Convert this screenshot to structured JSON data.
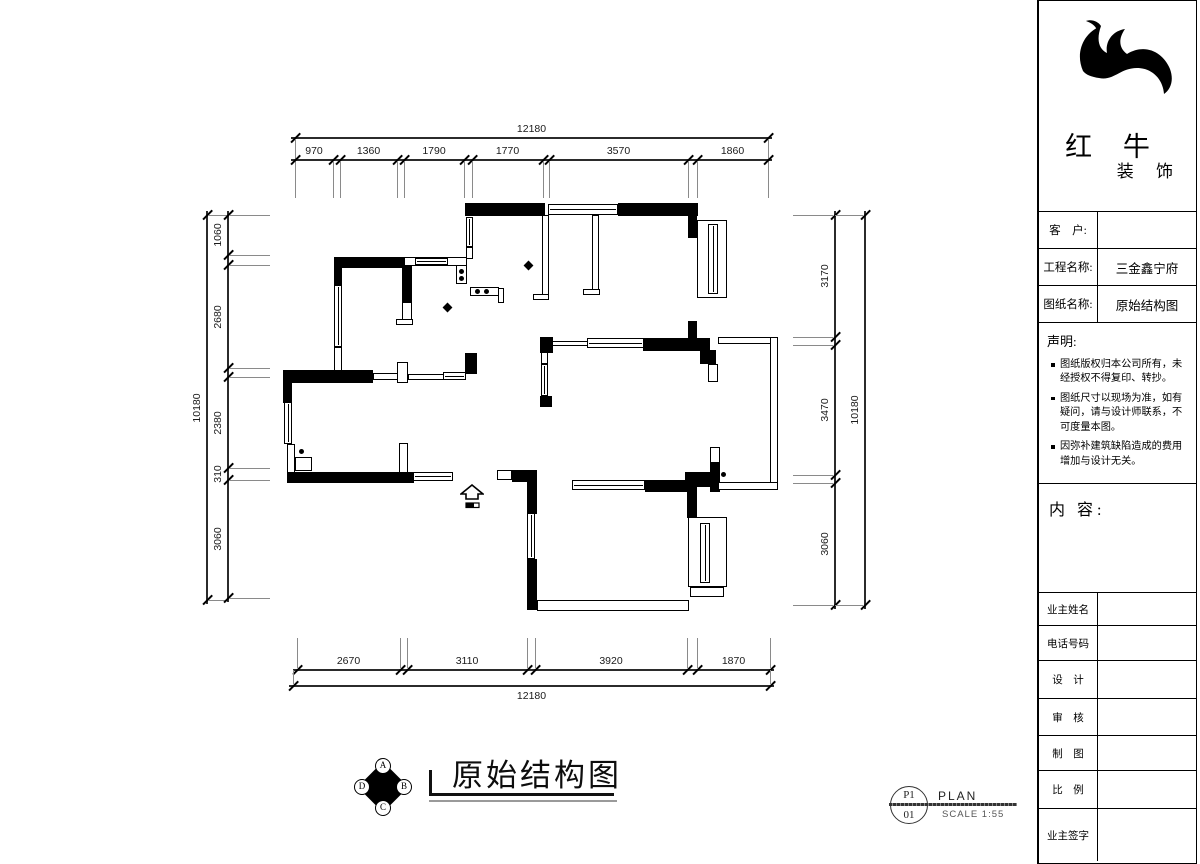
{
  "title_block": {
    "logo": {
      "line1": "红 牛",
      "line2": "装 饰"
    },
    "rows": [
      {
        "label": "客　户:",
        "value": ""
      },
      {
        "label": "工程名称:",
        "value": "三金鑫宁府"
      },
      {
        "label": "图纸名称:",
        "value": "原始结构图"
      }
    ],
    "statement": {
      "title": "声明:",
      "items": [
        "图纸版权归本公司所有，未经授权不得复印、转抄。",
        "图纸尺寸以现场为准，如有疑问，请与设计师联系，不可度量本图。",
        "因弥补建筑缺陷造成的费用增加与设计无关。"
      ]
    },
    "content_label": "内 容:",
    "sign_rows": [
      "业主姓名",
      "电话号码",
      "设　计",
      "审　核",
      "制　图",
      "比　例",
      "业主签字"
    ]
  },
  "plan_title": {
    "text": "原始结构图"
  },
  "compass": {
    "top": "A",
    "right": "B",
    "bottom": "C",
    "left": "D"
  },
  "stamp": {
    "sheet": "P1",
    "number": "01",
    "label": "PLAN",
    "scale": "SCALE 1:55"
  },
  "dimensions": {
    "top_total": "12180",
    "top_segments": [
      "970",
      "1360",
      "1790",
      "1770",
      "3570",
      "1860"
    ],
    "bottom_segments": [
      "2670",
      "3110",
      "3920",
      "1870"
    ],
    "bottom_total": "12180",
    "left_total": "10180",
    "left_segments": [
      "1060",
      "2680",
      "2380",
      "310",
      "3060"
    ],
    "right_segments": [
      "3170",
      "3470",
      "3060"
    ],
    "right_total": "10180"
  },
  "dim_rows": [
    {
      "o": "h",
      "y": 138,
      "x1": 295,
      "x2": 768,
      "ticks": [
        295,
        768
      ],
      "ext": {
        "dir": 1,
        "len": 22
      },
      "labels": [
        {
          "t": "12180",
          "a": 295,
          "b": 768
        }
      ]
    },
    {
      "o": "h",
      "y": 160,
      "x1": 295,
      "x2": 768,
      "ticks": [
        295,
        333,
        340,
        397,
        404,
        464,
        472,
        543,
        549,
        688,
        697,
        768
      ],
      "ext": {
        "dir": 1,
        "len": 36
      },
      "labels": [
        {
          "t": "970",
          "a": 295,
          "b": 333
        },
        {
          "t": "1360",
          "a": 340,
          "b": 397
        },
        {
          "t": "1790",
          "a": 404,
          "b": 464
        },
        {
          "t": "1770",
          "a": 472,
          "b": 543
        },
        {
          "t": "3570",
          "a": 549,
          "b": 688
        },
        {
          "t": "1860",
          "a": 697,
          "b": 768
        }
      ]
    },
    {
      "o": "h",
      "y": 670,
      "x1": 297,
      "x2": 770,
      "ticks": [
        297,
        400,
        407,
        527,
        535,
        687,
        697,
        770
      ],
      "ext": {
        "dir": -1,
        "len": 30
      },
      "labels": [
        {
          "t": "2670",
          "a": 297,
          "b": 400
        },
        {
          "t": "3110",
          "a": 407,
          "b": 527
        },
        {
          "t": "3920",
          "a": 535,
          "b": 687
        },
        {
          "t": "1870",
          "a": 697,
          "b": 770
        }
      ]
    },
    {
      "o": "h",
      "y": 686,
      "x1": 293,
      "x2": 770,
      "ticks": [
        293,
        770
      ],
      "ext": {
        "dir": -1,
        "len": 14
      },
      "labels": [
        {
          "t": "12180",
          "a": 293,
          "b": 770,
          "below": true
        }
      ]
    },
    {
      "o": "v",
      "x": 207,
      "y1": 215,
      "y2": 600,
      "ticks": [
        215,
        600
      ],
      "ext": {
        "dir": 1,
        "len": 19
      },
      "labels": [
        {
          "t": "10180",
          "a": 215,
          "b": 600
        }
      ]
    },
    {
      "o": "v",
      "x": 228,
      "y1": 215,
      "y2": 598,
      "ticks": [
        215,
        255,
        265,
        368,
        377,
        468,
        480,
        598
      ],
      "ext": {
        "dir": 1,
        "len": 40
      },
      "labels": [
        {
          "t": "1060",
          "a": 215,
          "b": 255
        },
        {
          "t": "2680",
          "a": 265,
          "b": 368
        },
        {
          "t": "2380",
          "a": 377,
          "b": 468
        },
        {
          "t": "310",
          "a": 468,
          "b": 480
        },
        {
          "t": "3060",
          "a": 480,
          "b": 598
        }
      ]
    },
    {
      "o": "v",
      "x": 835,
      "y1": 215,
      "y2": 605,
      "ticks": [
        215,
        337,
        345,
        475,
        483,
        605
      ],
      "ext": {
        "dir": -1,
        "len": 40
      },
      "labels": [
        {
          "t": "3170",
          "a": 215,
          "b": 337
        },
        {
          "t": "3470",
          "a": 345,
          "b": 475
        },
        {
          "t": "3060",
          "a": 483,
          "b": 605
        }
      ]
    },
    {
      "o": "v",
      "x": 865,
      "y1": 215,
      "y2": 605,
      "ticks": [
        215,
        605
      ],
      "ext": {
        "dir": -1,
        "len": 28
      },
      "labels": [
        {
          "t": "10180",
          "a": 215,
          "b": 605
        }
      ]
    }
  ],
  "plan": {
    "walls": [
      [
        "s",
        334,
        257,
        70,
        11
      ],
      [
        "s",
        334,
        267,
        8,
        18
      ],
      [
        "s",
        402,
        257,
        10,
        46
      ],
      [
        "s",
        465,
        203,
        80,
        13
      ],
      [
        "s",
        618,
        203,
        80,
        13
      ],
      [
        "s",
        688,
        216,
        9,
        22
      ],
      [
        "s",
        688,
        321,
        9,
        19
      ],
      [
        "s",
        643,
        338,
        67,
        13
      ],
      [
        "s",
        540,
        337,
        13,
        16
      ],
      [
        "s",
        283,
        370,
        90,
        13
      ],
      [
        "s",
        283,
        383,
        9,
        20
      ],
      [
        "s",
        287,
        472,
        127,
        11
      ],
      [
        "s",
        465,
        353,
        12,
        21
      ],
      [
        "s",
        540,
        396,
        12,
        11
      ],
      [
        "s",
        512,
        470,
        25,
        12
      ],
      [
        "s",
        527,
        470,
        10,
        44
      ],
      [
        "s",
        527,
        559,
        10,
        51
      ],
      [
        "s",
        645,
        480,
        52,
        12
      ],
      [
        "s",
        685,
        472,
        25,
        15
      ],
      [
        "s",
        687,
        492,
        10,
        26
      ],
      [
        "s",
        700,
        350,
        16,
        14
      ],
      [
        "s",
        710,
        462,
        10,
        30
      ],
      [
        "t",
        404,
        257,
        63,
        9
      ],
      [
        "t",
        334,
        347,
        8,
        24
      ],
      [
        "t",
        402,
        302,
        10,
        22
      ],
      [
        "t",
        396,
        319,
        17,
        6
      ],
      [
        "t",
        466,
        247,
        7,
        12
      ],
      [
        "t",
        542,
        215,
        7,
        81
      ],
      [
        "t",
        533,
        294,
        16,
        6
      ],
      [
        "t",
        592,
        215,
        7,
        77
      ],
      [
        "t",
        583,
        289,
        17,
        6
      ],
      [
        "t",
        552,
        341,
        36,
        5
      ],
      [
        "t",
        697,
        220,
        30,
        78
      ],
      [
        "t",
        373,
        373,
        25,
        7
      ],
      [
        "t",
        397,
        362,
        11,
        21
      ],
      [
        "t",
        408,
        374,
        36,
        6
      ],
      [
        "t",
        295,
        457,
        17,
        14
      ],
      [
        "t",
        287,
        444,
        8,
        29
      ],
      [
        "t",
        399,
        443,
        9,
        30
      ],
      [
        "t",
        497,
        470,
        15,
        10
      ],
      [
        "t",
        537,
        600,
        152,
        11
      ],
      [
        "t",
        688,
        517,
        39,
        70
      ],
      [
        "t",
        690,
        587,
        34,
        10
      ],
      [
        "t",
        708,
        364,
        10,
        18
      ],
      [
        "t",
        710,
        447,
        10,
        16
      ],
      [
        "t",
        456,
        265,
        11,
        19
      ],
      [
        "t",
        470,
        287,
        29,
        9
      ],
      [
        "t",
        498,
        288,
        6,
        15
      ],
      [
        "t",
        541,
        352,
        7,
        12
      ],
      [
        "t",
        718,
        337,
        60,
        7
      ],
      [
        "t",
        770,
        337,
        8,
        153
      ],
      [
        "t",
        718,
        482,
        60,
        8
      ],
      [
        "wh",
        415,
        258,
        33,
        7
      ],
      [
        "wh",
        548,
        204,
        70,
        11
      ],
      [
        "wh",
        587,
        338,
        57,
        10
      ],
      [
        "wh",
        443,
        372,
        23,
        8
      ],
      [
        "wh",
        413,
        472,
        40,
        9
      ],
      [
        "wh",
        572,
        480,
        73,
        10
      ],
      [
        "wv",
        334,
        285,
        8,
        62
      ],
      [
        "wv",
        466,
        217,
        7,
        30
      ],
      [
        "wv",
        284,
        402,
        8,
        42
      ],
      [
        "wv",
        527,
        513,
        8,
        46
      ],
      [
        "wv",
        708,
        224,
        10,
        70
      ],
      [
        "wv",
        700,
        523,
        10,
        60
      ],
      [
        "wv",
        541,
        364,
        7,
        32
      ]
    ],
    "dots": [
      [
        301,
        451
      ],
      [
        723,
        474
      ],
      [
        461,
        271
      ],
      [
        461,
        278
      ],
      [
        477,
        291
      ],
      [
        486,
        291
      ]
    ],
    "diamonds": [
      [
        447,
        307
      ],
      [
        528,
        265
      ]
    ]
  }
}
